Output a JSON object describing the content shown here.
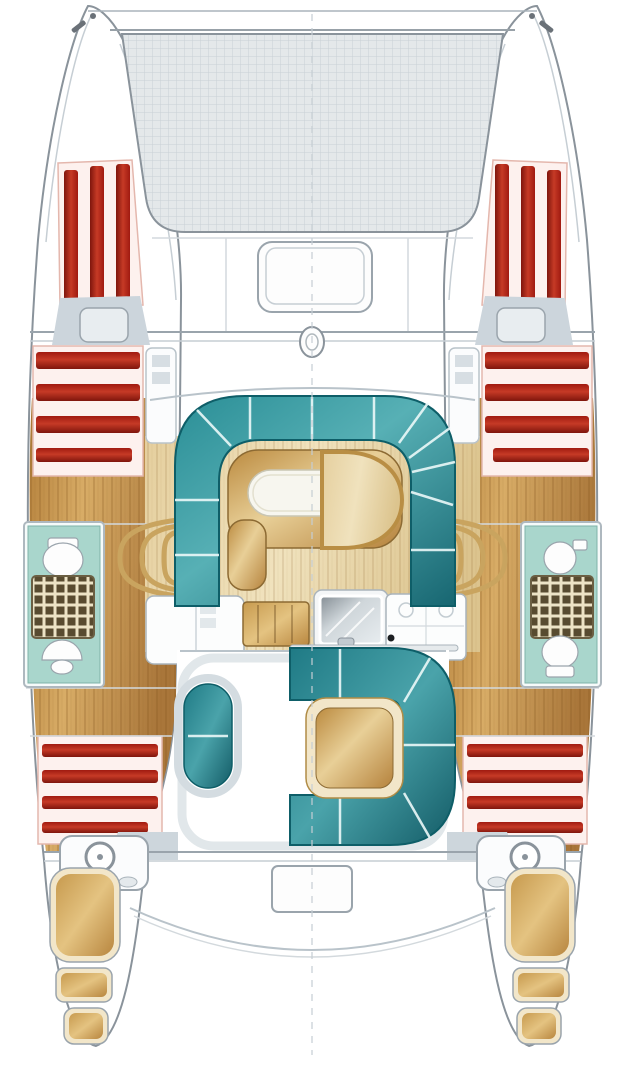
{
  "diagram": {
    "subject": "catamaran sailboat deck and accommodation floor plan",
    "orientation": "bow-up, top-down view"
  },
  "colors": {
    "background": "#ffffff",
    "outline": "#8a939b",
    "outline_light": "#c6ced4",
    "deck_line": "#d3d9dd",
    "tramp_fill": "#e4e8ea",
    "tramp_grid": "#c9d0d5",
    "red_dark": "#7f150c",
    "red_mid": "#c63a26",
    "red_base": "#a01a10",
    "mattress": "#fdf1ee",
    "mattress_border": "#e4b7ad",
    "teal_a": "#2a8e96",
    "teal_b": "#57b0b5",
    "teal_c": "#176671",
    "teal_outline": "#0e5e68",
    "ck_teal_a": "#1f7a85",
    "ck_teal_b": "#4aa3aa",
    "ck_teal_c": "#135b66",
    "wood_a": "#b5813c",
    "wood_b": "#d8ac66",
    "wood_c": "#a9763a",
    "pale_a": "#e5cf9e",
    "pale_b": "#f0e2bd",
    "pale_c": "#dcc48e",
    "table_a": "#bb8a3f",
    "table_b": "#e8cf97",
    "table_c": "#b5823c",
    "step_a": "#c79a4e",
    "step_b": "#e4c381",
    "step_c": "#b8863f",
    "step_border": "#f2e6c9",
    "bath_teal": "#a9d6cc",
    "bath_border": "#7fb3a9",
    "shower_dark": "#584b30",
    "shower_light": "#ece3c6",
    "metal_a": "#848d94",
    "metal_b": "#cfd6da",
    "metal_c": "#e8edf0",
    "hatch_gray": "#ccd5dc",
    "hatch_light": "#e8edf0",
    "walkway_gray": "#e1e7ea",
    "wedge_gray": "#cdd6dc",
    "fixture": "#fdfdfd",
    "white_soft": "#f7f6ef",
    "rail": "#c9a45f",
    "rail_dark": "#a9853f",
    "dot": "#1c1f22"
  }
}
